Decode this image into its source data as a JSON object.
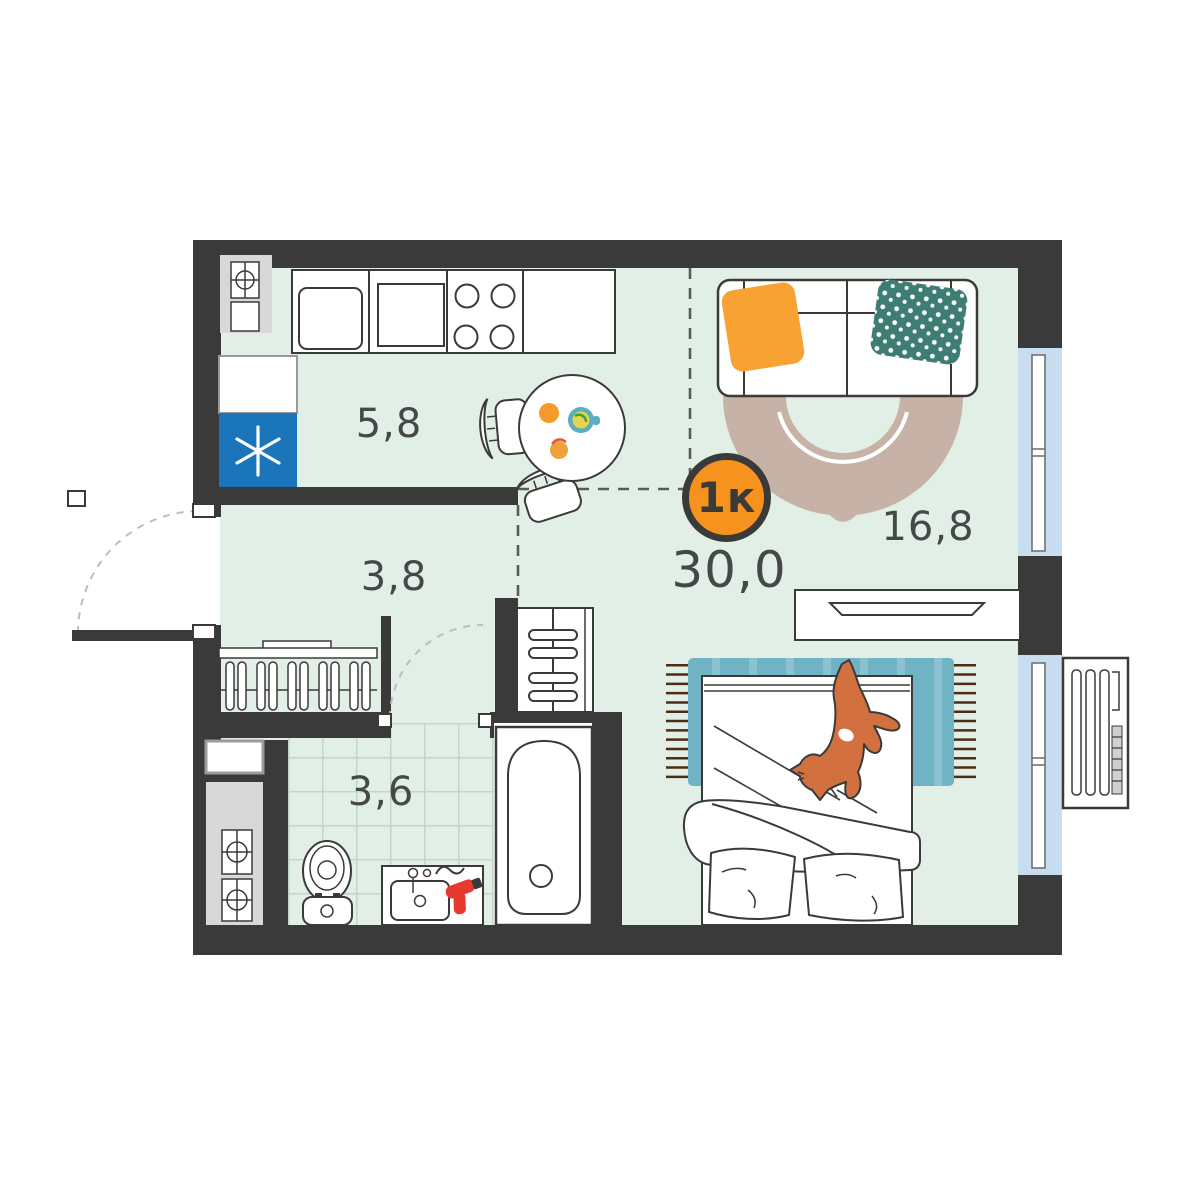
{
  "plan": {
    "type_badge": {
      "label": "1к"
    },
    "total_area": "30,0",
    "rooms": [
      {
        "id": "kitchen",
        "area": "5,8"
      },
      {
        "id": "hallway",
        "area": "3,8"
      },
      {
        "id": "bathroom",
        "area": "3,6"
      },
      {
        "id": "living-room",
        "area": "16,8"
      }
    ]
  },
  "colors": {
    "wall": "#3a3a3a",
    "floor": "#e2efe6",
    "tile-line": "#c3d5c7",
    "window": "#c9ddf1",
    "accent": "#f6921e",
    "label": "#45484a",
    "fridge-blue": "#1b75bb",
    "rug-beige": "#c6b2a6",
    "rug-teal": "#6fb3c4",
    "rug-teal-stripe": "#8ac2d0",
    "pillow-orange": "#f7a233",
    "pillow-teal": "#3e7d74",
    "cat-orange": "#d3703f",
    "dryer-red": "#e8392e",
    "fringe-brown": "#4c2c15",
    "shaft-gray": "#d8d8d8"
  }
}
